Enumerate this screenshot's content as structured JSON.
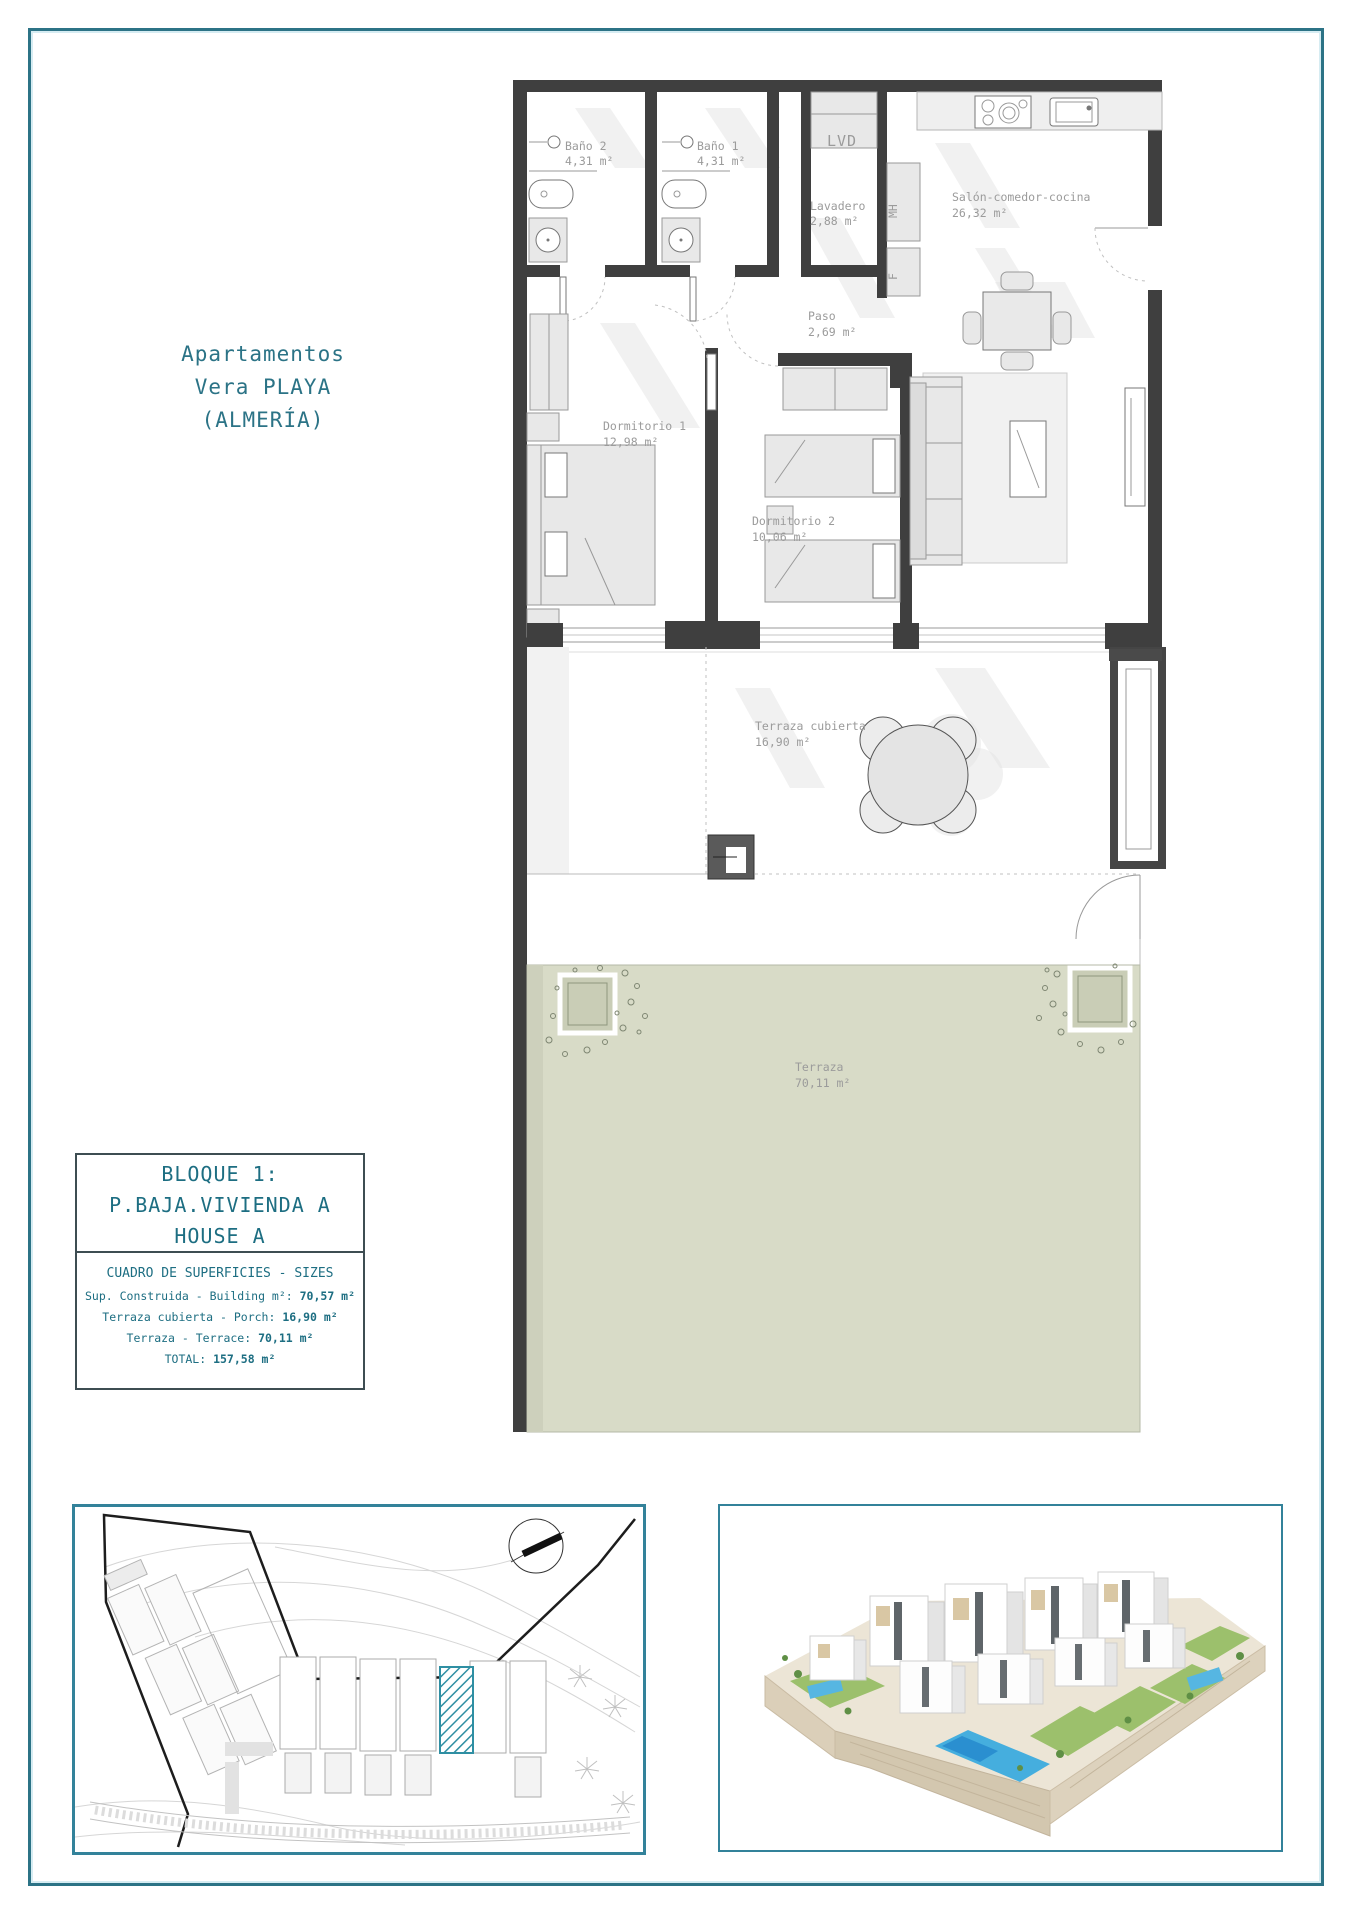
{
  "title": {
    "line1": "Apartamentos",
    "line2": "Vera PLAYA",
    "line3": "(ALMERÍA)"
  },
  "plan": {
    "bano2_name": "Baño 2",
    "bano2_area": "4,31 m²",
    "bano1_name": "Baño 1",
    "bano1_area": "4,31 m²",
    "lvd_label": "LVD",
    "lavadero_name": "Lavadero",
    "lavadero_area": "2,88 m²",
    "mh_label": "MH",
    "f_label": "F",
    "salon_name": "Salón-comedor-cocina",
    "salon_area": "26,32 m²",
    "paso_name": "Paso",
    "paso_area": "2,69 m²",
    "dorm1_name": "Dormitorio 1",
    "dorm1_area": "12,98 m²",
    "dorm2_name": "Dormitorio 2",
    "dorm2_area": "10,06 m²",
    "terraza_cubierta_name": "Terraza cubierta",
    "terraza_cubierta_area": "16,90 m²",
    "terraza_name": "Terraza",
    "terraza_area": "70,11 m²"
  },
  "info_box": {
    "bloque": "BLOQUE 1:",
    "vivienda": "P.BAJA.VIVIENDA A",
    "house": "HOUSE A",
    "sizes_title": "CUADRO DE SUPERFICIES  - SIZES",
    "rows": [
      {
        "label": "Sup. Construida  - Building m²: ",
        "value": "70,57 m²"
      },
      {
        "label": "Terraza cubierta  - Porch: ",
        "value": "16,90 m²"
      },
      {
        "label": "Terraza - Terrace: ",
        "value": "70,11 m²"
      },
      {
        "label": "TOTAL:  ",
        "value": "157,58 m²"
      }
    ]
  },
  "colors": {
    "teal_text": "#2b7386",
    "frame_border": "#2c7386",
    "box_border": "#33829a",
    "wall": "#3f3f3f",
    "label_gray": "#9b9b9b",
    "terrace_green": "#d8dbc7",
    "site_hatch_teal": "#2f8fa3",
    "pool_blue": "#45aede"
  }
}
